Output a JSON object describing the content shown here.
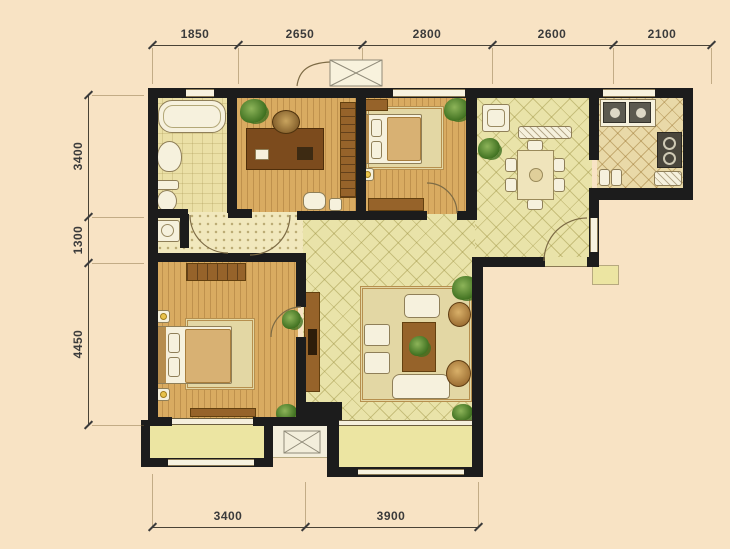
{
  "scene": {
    "type": "residential-apartment-floor-plan",
    "rooms": [
      "bathroom",
      "laundry",
      "study",
      "bedroom-2",
      "dining-room",
      "kitchen",
      "hallway",
      "living-room",
      "master-bedroom",
      "balcony-left",
      "ac-platform",
      "balcony-right",
      "entry"
    ]
  },
  "dimensions": {
    "top": [
      "1850",
      "2650",
      "2800",
      "2600",
      "2100"
    ],
    "left": [
      "3400",
      "1300",
      "4450"
    ],
    "bottom": [
      "3400",
      "3900"
    ]
  },
  "colors": {
    "background": "#f8e3c4",
    "wall": "#1c1c1c",
    "wood_floor": "#d9ab61",
    "tile_floor": "#e9e3a9",
    "kitchen_floor": "#e9d9a8",
    "hall_floor": "#f1e8bd",
    "balcony_floor": "#ece5a2",
    "furniture_brown": "#96632a",
    "plant_green": "#5d8f33",
    "dimension_text": "#3b3b3b"
  }
}
